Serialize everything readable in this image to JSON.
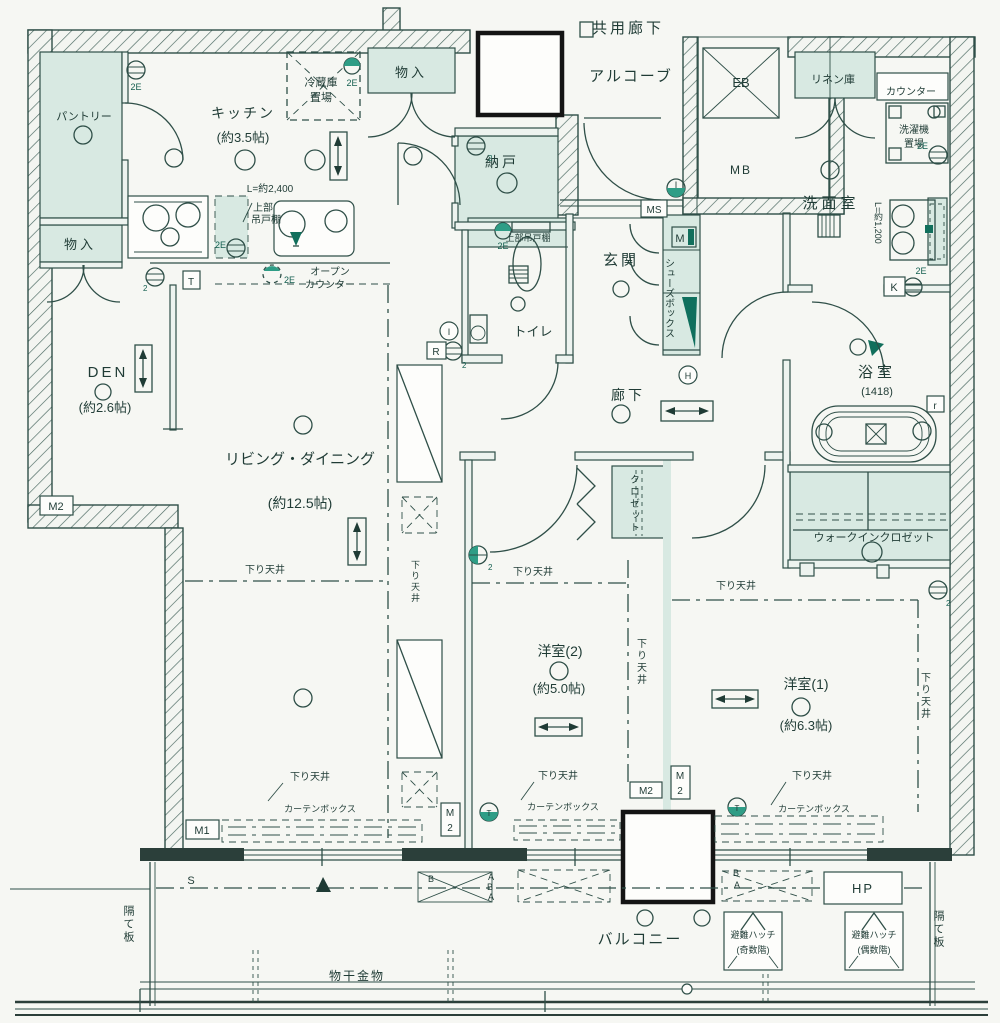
{
  "colors": {
    "line": "#2f4f48",
    "accent_green_fill": "#d8e9e2",
    "dark_green": "#116f5c",
    "paper": "#f6f7f3",
    "black_box": "#141414"
  },
  "rooms": {
    "corridor": "共用廊下",
    "alcove": "アルコーブ",
    "pantry": "パントリー",
    "kitchen": "キッチン",
    "kitchen_size": "(約3.5帖)",
    "den": "DEN",
    "den_size": "(約2.6帖)",
    "living": "リビング・ダイニング",
    "living_size": "(約12.5帖)",
    "nando": "納戸",
    "toilet": "トイレ",
    "genkan": "玄関",
    "hall": "廊下",
    "washroom": "洗面室",
    "bathroom": "浴室",
    "bathroom_size": "(1418)",
    "wic": "ウォークインクロゼット",
    "closet": "クロゼット",
    "western2": "洋室(2)",
    "western2_size": "(約5.0帖)",
    "western1": "洋室(1)",
    "western1_size": "(約6.3帖)",
    "balcony": "バルコニー"
  },
  "features": {
    "monoire": "物入",
    "fridge1": "冷蔵庫",
    "fridge2": "置場",
    "linen": "リネン庫",
    "counter": "カウンター",
    "washer1": "洗濯機",
    "washer2": "置場",
    "upper1": "上部",
    "upper2": "吊戸棚",
    "upper_cab": "上部吊戸棚",
    "open1": "オープン",
    "open2": "カウンター",
    "shoes": "シューズボックス",
    "kitchen_l": "L=約2,400",
    "vanity_l": "L=約1,200",
    "down_ceiling": "下り天井",
    "curtain": "カーテンボックス",
    "laundry": "物干金物",
    "partition": "隔て板",
    "evac_hatch": "避難ハッチ",
    "evac_odd": "(奇数階)",
    "evac_even": "(偶数階)"
  },
  "markers": {
    "eb": "EB",
    "mb": "MB",
    "ms": "MS",
    "m": "M",
    "m1": "M1",
    "m2": "M2",
    "k": "K",
    "t": "T",
    "s": "S",
    "h": "H",
    "i": "I",
    "r": "R",
    "r2": "r",
    "hp": "HP",
    "b": "B",
    "a": "A",
    "e2": "2E",
    "two": "2"
  }
}
